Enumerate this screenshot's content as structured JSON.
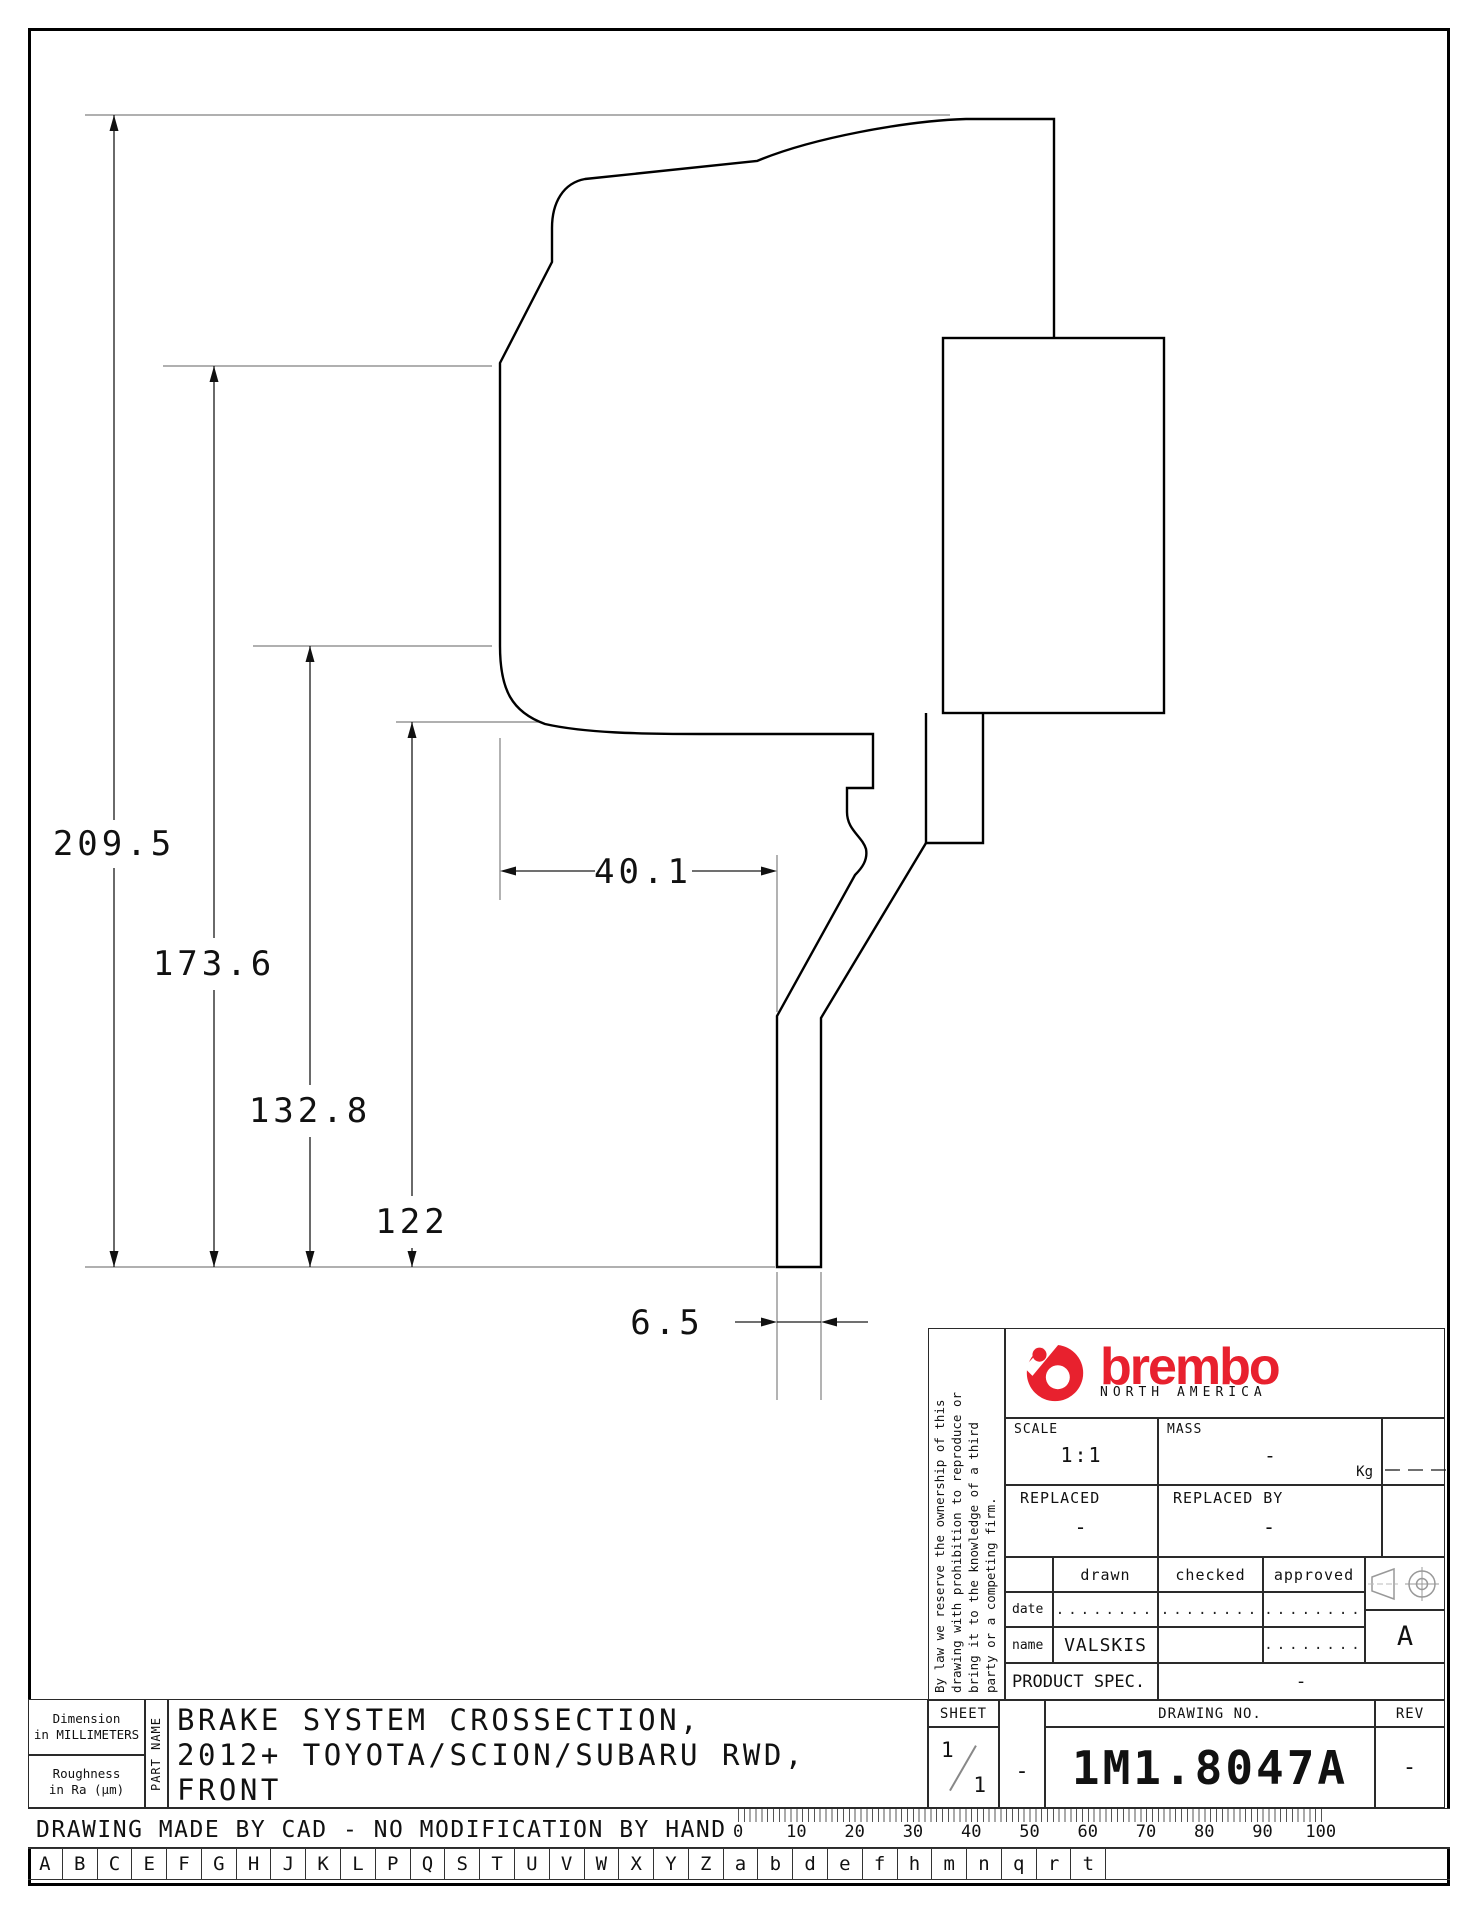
{
  "drawing": {
    "dimensions": {
      "overall": "209.5",
      "upper": "173.6",
      "middle": "132.8",
      "inner": "122",
      "offset": "40.1",
      "thickness": "6.5"
    }
  },
  "title_block": {
    "disclaimer_lines": [
      "By law we reserve the ownership of this",
      "drawing with prohibition to reproduce or",
      "bring it to the knowledge of a third",
      "party or a competing firm."
    ],
    "brand": {
      "name": "brembo",
      "region": "NORTH AMERICA"
    },
    "scale": {
      "label": "SCALE",
      "value": "1:1"
    },
    "mass": {
      "label": "MASS",
      "value": "-",
      "unit": "Kg"
    },
    "replaced": {
      "label": "REPLACED",
      "value": "-"
    },
    "replaced_by": {
      "label": "REPLACED BY",
      "value": "-"
    },
    "sign": {
      "col_drawn": "drawn",
      "col_checked": "checked",
      "col_approved": "approved",
      "row_date": "date",
      "row_name": "name",
      "date_drawn": "........",
      "date_checked": "........",
      "date_approved": "........",
      "name_drawn": "VALSKIS",
      "name_checked": "",
      "name_approved": "........"
    },
    "product_spec": {
      "label": "PRODUCT SPEC.",
      "value": "-"
    },
    "sheet": {
      "label": "SHEET",
      "numerator": "1",
      "denominator": "1",
      "dash": "-"
    },
    "drawing_no": {
      "label": "DRAWING NO.",
      "value": "1M1.8047A"
    },
    "rev": {
      "label": "REV",
      "value": "-"
    },
    "format_mark": "A"
  },
  "part_info": {
    "dimension_note_1": "Dimension",
    "dimension_note_2": "in MILLIMETERS",
    "roughness_note_1": "Roughness",
    "roughness_note_2": "in Ra (µm)",
    "part_name_label": "PART NAME",
    "part_name_lines": [
      "BRAKE SYSTEM CROSSECTION,",
      "2012+ TOYOTA/SCION/SUBARU RWD,",
      "FRONT"
    ],
    "cad_note": "DRAWING MADE BY CAD - NO MODIFICATION BY HAND"
  },
  "ruler": {
    "labels": [
      "0",
      "10",
      "20",
      "30",
      "40",
      "50",
      "60",
      "70",
      "80",
      "90",
      "100"
    ]
  },
  "strip": {
    "letters": [
      "A",
      "B",
      "C",
      "E",
      "F",
      "G",
      "H",
      "J",
      "K",
      "L",
      "P",
      "Q",
      "S",
      "T",
      "U",
      "V",
      "W",
      "X",
      "Y",
      "Z",
      "a",
      "b",
      "d",
      "e",
      "f",
      "h",
      "m",
      "n",
      "q",
      "r",
      "t"
    ]
  },
  "colors": {
    "brand_red": "#e8212e",
    "line": "#000000",
    "thin_line": "#808080"
  }
}
